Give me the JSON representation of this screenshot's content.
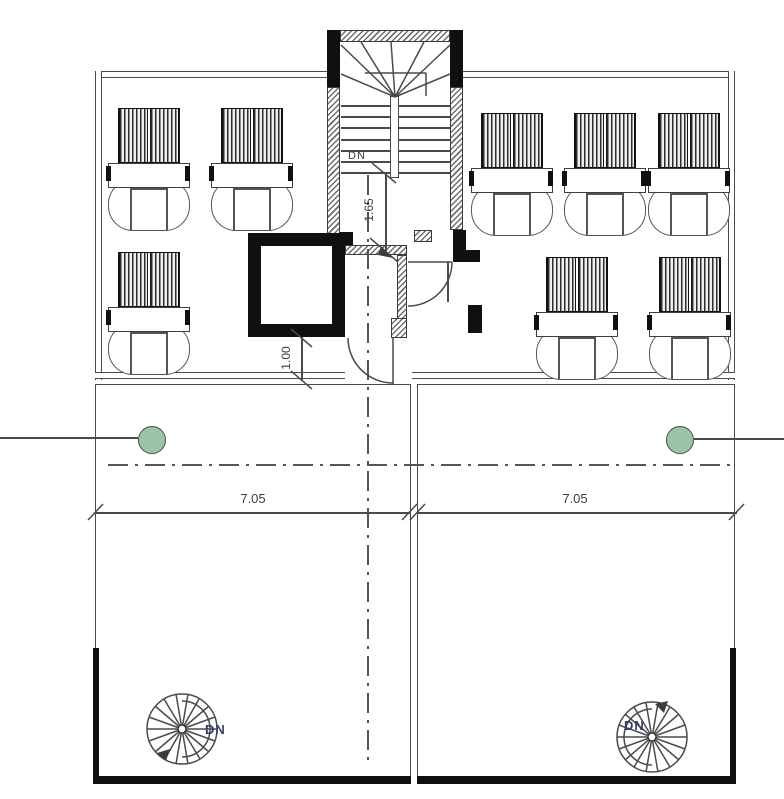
{
  "drawing": {
    "type": "architectural floor plan, upper level with stair, elevator shaft and two roof terraces",
    "labels": {
      "stair_down": "DN",
      "spiral_left_down": "DN",
      "spiral_right_down": "DN"
    },
    "dimensions": {
      "stair_flight": "1.65",
      "wall_opening": "1.00",
      "terrace_left_width": "7.05",
      "terrace_right_width": "7.05"
    },
    "symbols": {
      "column_marker": "green filled circle on grid line",
      "spiral_stair": "circle with radial treads and DN arrow",
      "workstation": "striped panel + desk + rounded seat, 8 total"
    },
    "colors": {
      "column_fill": "#9bc4a8",
      "column_stroke": "#4a4a4a",
      "line": "#4a4a4a",
      "wall_poche": "#101010",
      "dn_text": "#333e66"
    }
  }
}
